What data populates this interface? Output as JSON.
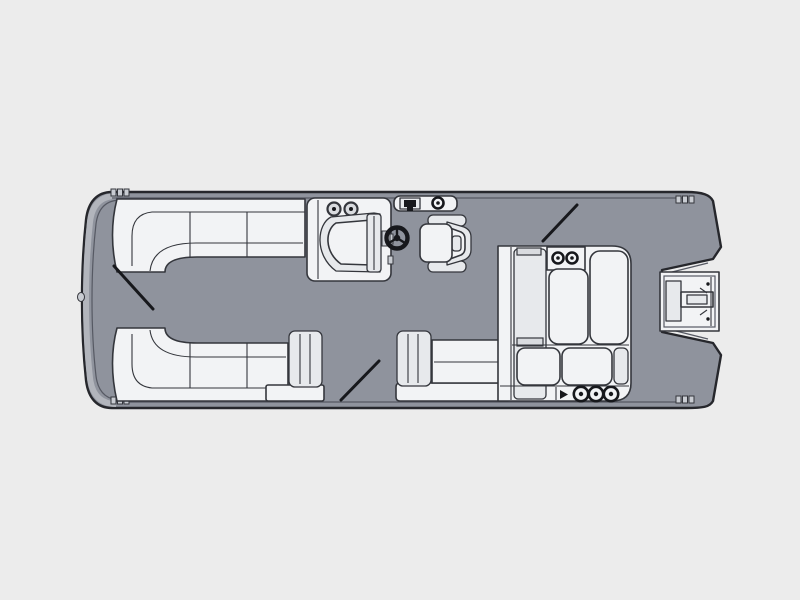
{
  "figure": {
    "kind": "boat-floorplan-top-view",
    "subject": "pontoon-boat-deck-plan",
    "orientation": {
      "bow": "left",
      "stern": "right"
    }
  },
  "colors": {
    "background": "#ececec",
    "deck": "#8f939d",
    "hull_outline": "#26272c",
    "rim_band": "#b2b5bc",
    "rail_line": "#565963",
    "seat_fill": "#f2f3f5",
    "seat_shade": "#e7e9ec",
    "seat_shade_dark": "#d9dbdf",
    "seat_outline": "#34363c",
    "detail_dark": "#17181c",
    "hardware": "#c9ccd2"
  },
  "components": [
    "hull",
    "bow-navigation-light",
    "bow-rub-rail",
    "corner-cleats",
    "bow-lounge-top",
    "bow-lounge-bottom",
    "helm-console",
    "console-speakers",
    "helm-windshield",
    "steering-wheel",
    "rail-accessory-panel",
    "gate-latch",
    "rail-light",
    "captain-chair",
    "midship-bench",
    "bench-armrests",
    "stern-lounge",
    "stern-lounge-cupholders",
    "aft-bar-cupholders",
    "motor-mount-pod",
    "gate-swing-marks"
  ],
  "counts": {
    "console_speakers": 2,
    "stern_lounge_cupholders": 2,
    "aft_bar_cupholders": 3,
    "corner_cleats": 4,
    "gate_swing_marks": 3
  }
}
